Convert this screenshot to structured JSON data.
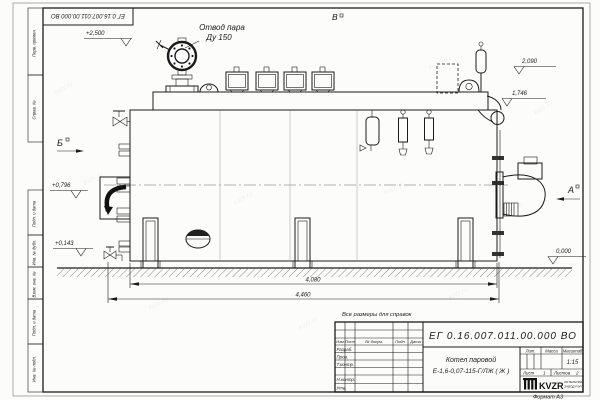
{
  "page": {
    "stamp_top": "ЕГ 0.16.007.011.00.000  ВО",
    "format_label": "Формат А3",
    "watermark": "kvzr.ru"
  },
  "margin": {
    "top_cells": [
      "Перв. примен.",
      "Справ. №"
    ],
    "bottom_cells": [
      "Подп. и дата",
      "Инв. № дубл.",
      "Взам. инв. №",
      "Подп. и дата",
      "Инв. № подл."
    ]
  },
  "labels": {
    "steam_outlet_line1": "Отвод пара",
    "steam_outlet_line2": "Ду 150",
    "note": "Все размеры для справок",
    "view_top": "В",
    "view_left": "Б",
    "view_right": "А"
  },
  "dims": {
    "elev_top": "+2,500",
    "elev_r1": "2,090",
    "elev_r2": "1,746",
    "elev_l1": "+0,796",
    "elev_l2": "+0,143",
    "elev_zero": "0,000",
    "len_inner": "4,080",
    "len_outer": "4,460"
  },
  "title_block": {
    "doc_number": "ЕГ 0.16.007.011.00.000  ВО",
    "name_line1": "Котел паровой",
    "name_line2": "Е-1,6-0,07-115-Г/ЛЖ ( Ж )",
    "cols": [
      "Изм",
      "Лист",
      "№ докум.",
      "Подп.",
      "Дата"
    ],
    "rows": [
      "Разраб.",
      "Пров.",
      "Т.контр.",
      "",
      "Н.контр.",
      "Утв."
    ],
    "lit": "Лит.",
    "mass": "Масса",
    "scale_lbl": "Масштаб",
    "scale": "1:15",
    "sheet_lbl": "Лист",
    "sheet": "1",
    "sheets_lbl": "Листов",
    "sheets": "2",
    "brand": "KVZR",
    "brand_sub1": "КОТЕЛЬНЫЙ",
    "brand_sub2": "ЗАВОД РЭП"
  }
}
